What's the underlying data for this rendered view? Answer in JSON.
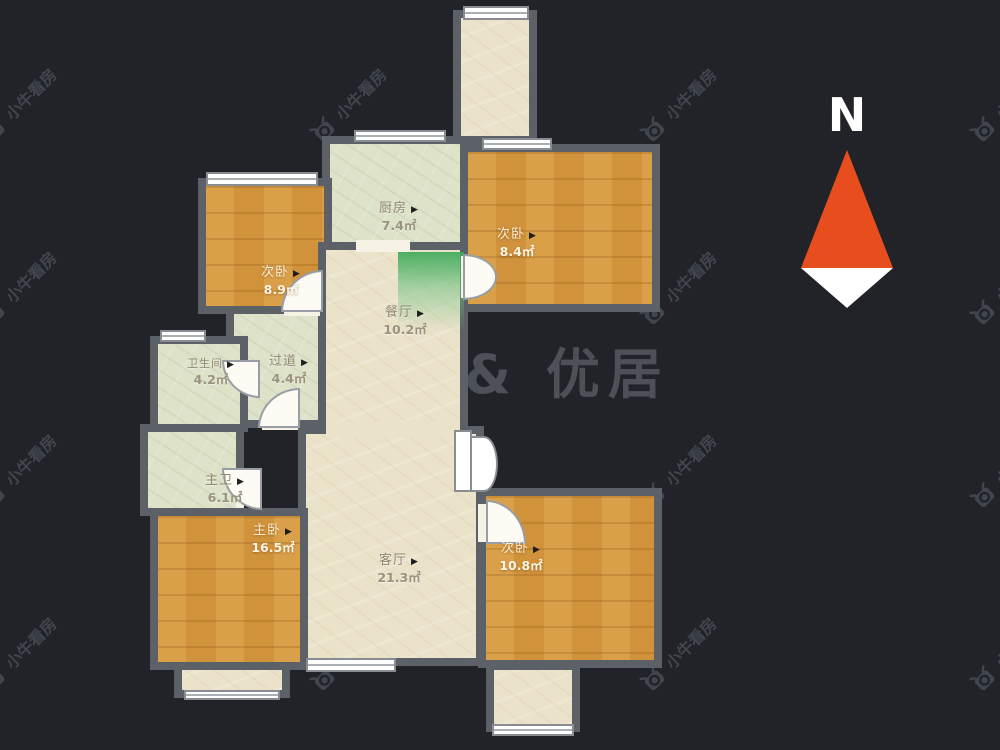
{
  "scene": {
    "background_color": "#212329",
    "kind": "apartment-floor-plan"
  },
  "compass": {
    "north_label": "N",
    "arrow_red": "#e84e1d",
    "arrow_white": "#ffffff"
  },
  "watermark": {
    "tile_text": "小牛看房",
    "center_text": "& 优居"
  },
  "ui": {
    "marker": "▶"
  },
  "rooms": [
    {
      "name": "厨房",
      "area": "7.4㎡"
    },
    {
      "name": "次卧",
      "area": "8.4㎡"
    },
    {
      "name": "次卧",
      "area": "8.9㎡"
    },
    {
      "name": "餐厅",
      "area": "10.2㎡"
    },
    {
      "name": "卫生间",
      "area": "4.2㎡"
    },
    {
      "name": "过道",
      "area": "4.4㎡"
    },
    {
      "name": "主卫",
      "area": "6.1㎡"
    },
    {
      "name": "主卧",
      "area": "16.5㎡"
    },
    {
      "name": "客厅",
      "area": "21.3㎡"
    },
    {
      "name": "次卧",
      "area": "10.8㎡"
    }
  ],
  "colors": {
    "floor_wood": "#d6983f",
    "floor_beige": "#ebe2ca",
    "floor_sage": "#dde2c9",
    "wall": "#5c6167",
    "entry_green": "#3eaa5a"
  }
}
